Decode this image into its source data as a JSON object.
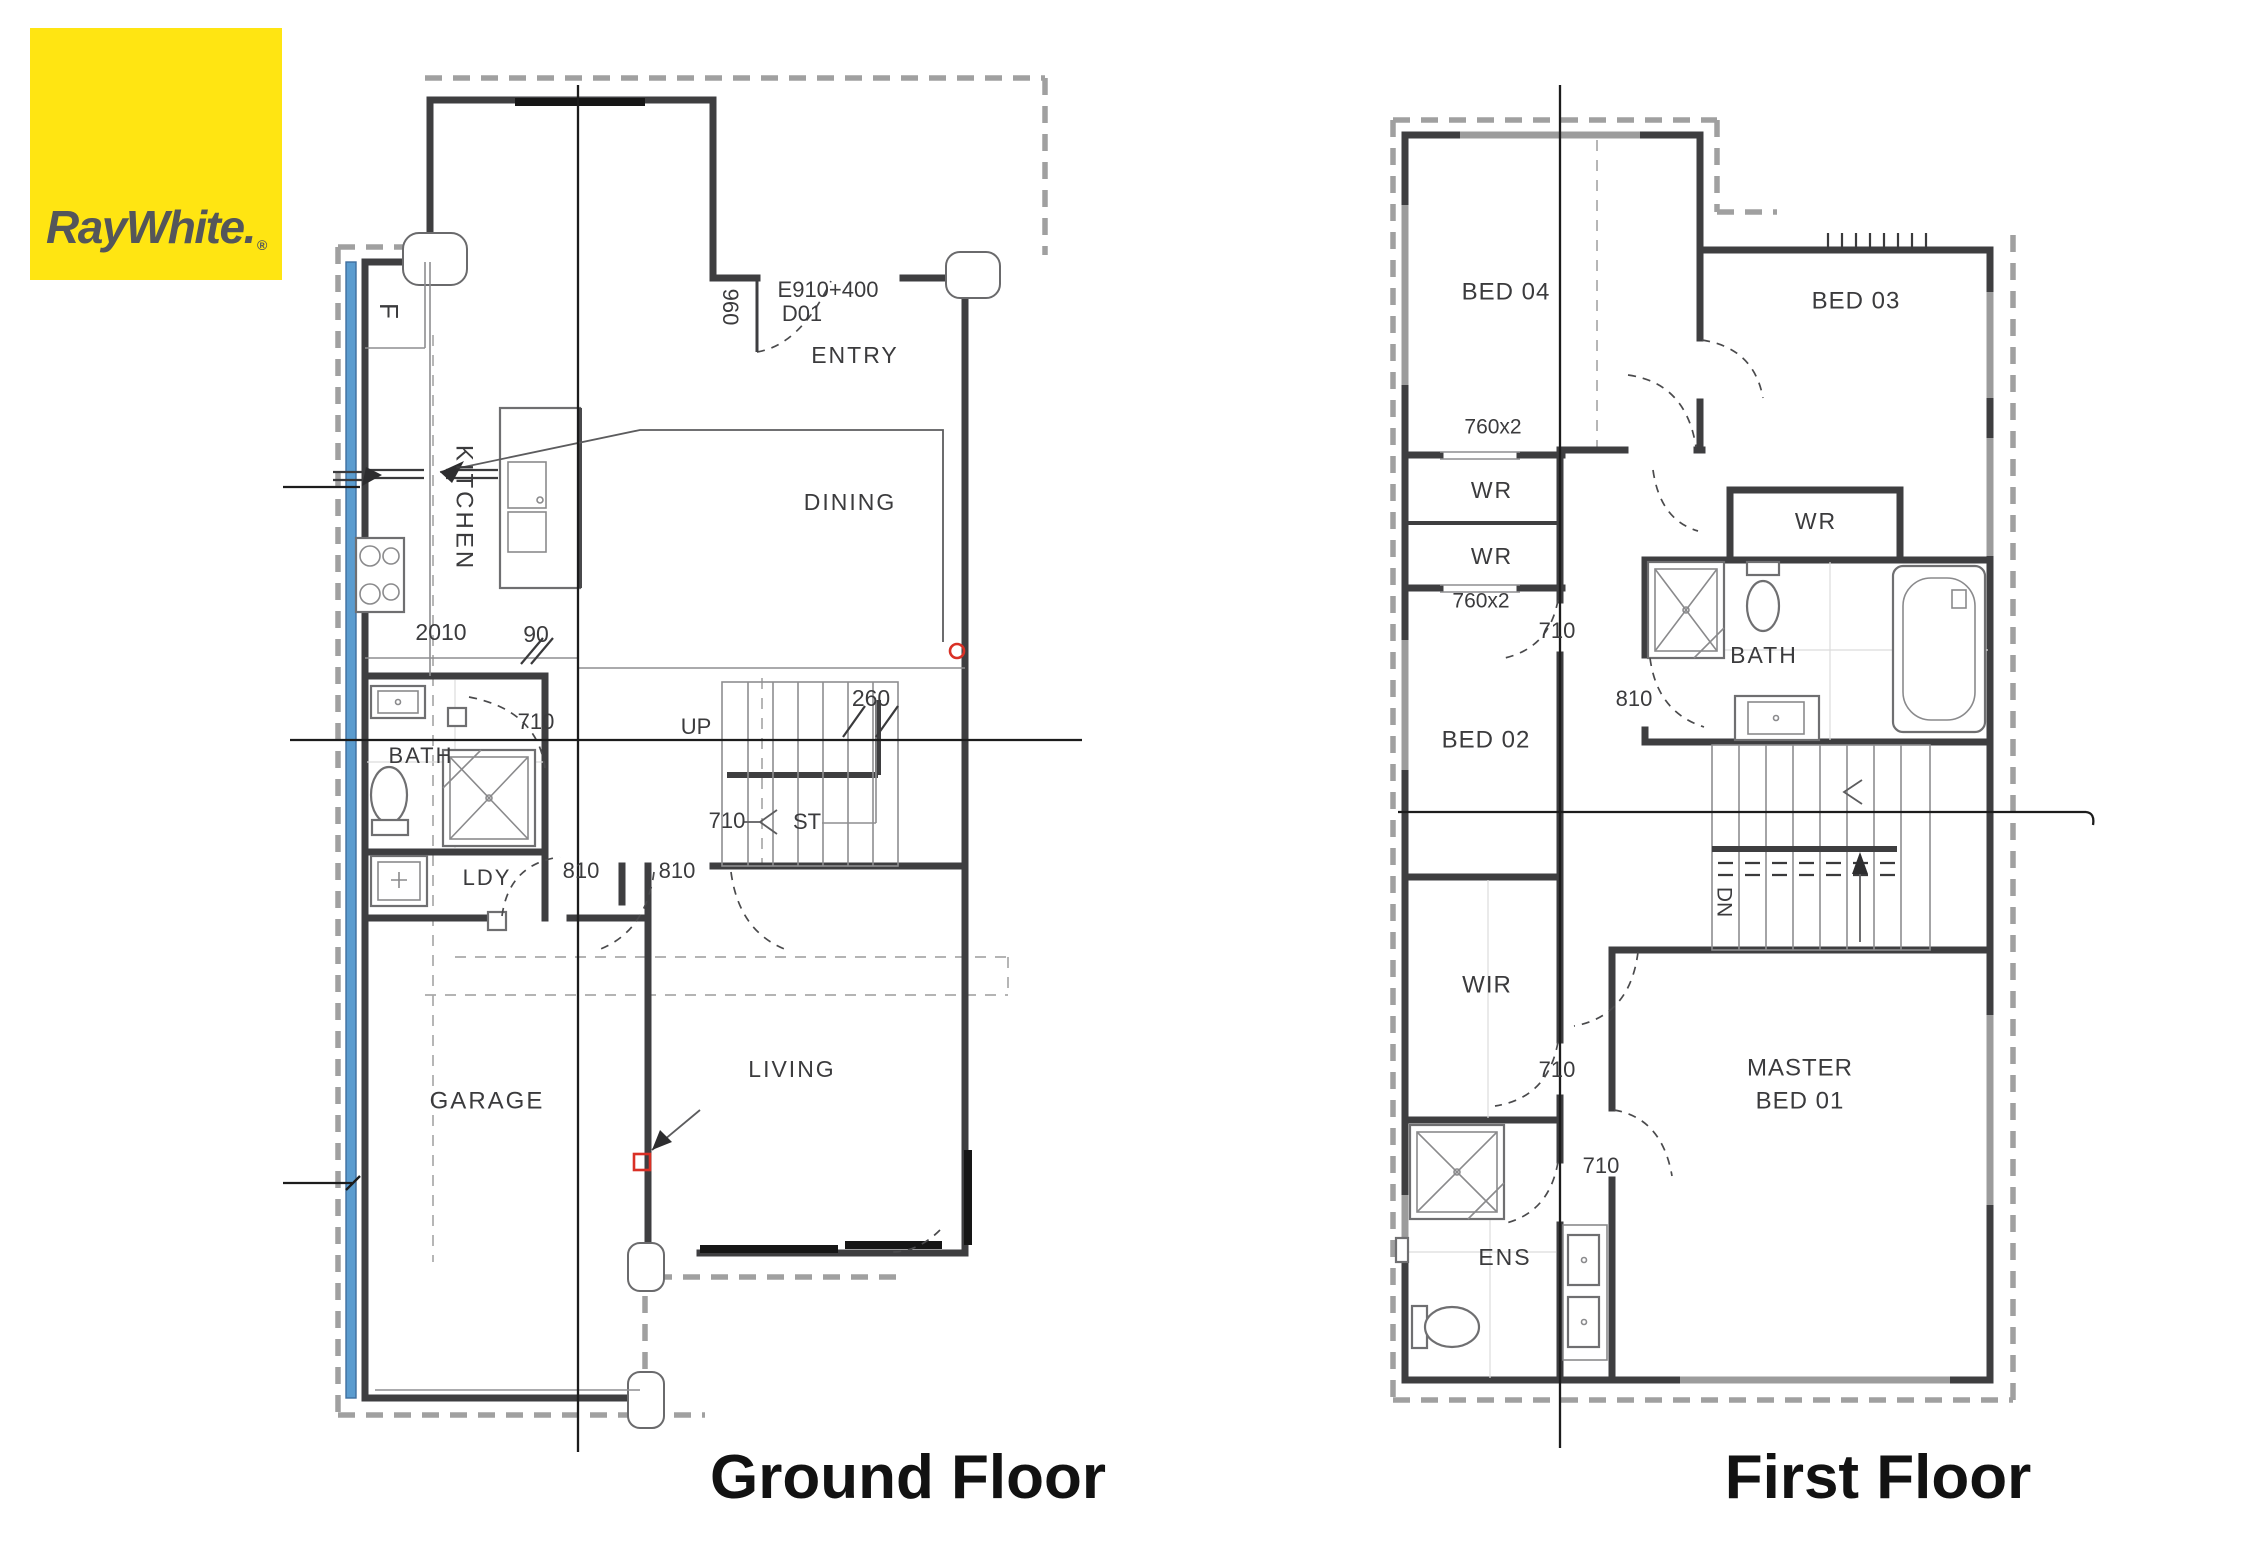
{
  "logo": {
    "brand": "RayWhite.",
    "registered": "®"
  },
  "captions": {
    "ground": "Ground Floor",
    "first": "First Floor"
  },
  "colors": {
    "logo_bg": "#FFE512",
    "logo_fg": "#54565A",
    "wall": "#3E3E40",
    "thin": "#8E8E90",
    "boundary": "#A0A0A0",
    "section": "#1C1C1C",
    "window_blue": "#5B9CCF",
    "marker_red": "#D93025",
    "text": "#3B3B3D",
    "caption": "#121212"
  },
  "ground_floor": {
    "name": "Ground Floor",
    "labels": [
      {
        "id": "fridge",
        "text": "F",
        "x": 387,
        "y": 311,
        "size": 26,
        "rot": 90
      },
      {
        "id": "kitchen",
        "text": "KITCHEN",
        "x": 463,
        "y": 508,
        "size": 24,
        "rot": 90,
        "ls": 3
      },
      {
        "id": "dim-2010",
        "text": "2010",
        "x": 441,
        "y": 634,
        "size": 23
      },
      {
        "id": "dim-90",
        "text": "90",
        "x": 536,
        "y": 636,
        "size": 23
      },
      {
        "id": "dim-710-bath",
        "text": "710",
        "x": 536,
        "y": 723,
        "size": 22
      },
      {
        "id": "room-bath",
        "text": "BATH",
        "x": 421,
        "y": 757,
        "size": 22,
        "ls": 2
      },
      {
        "id": "room-ldy",
        "text": "LDY",
        "x": 487,
        "y": 879,
        "size": 22,
        "ls": 2
      },
      {
        "id": "dim-810-a",
        "text": "810",
        "x": 581,
        "y": 872,
        "size": 22
      },
      {
        "id": "dim-810-b",
        "text": "810",
        "x": 677,
        "y": 872,
        "size": 22
      },
      {
        "id": "dim-960",
        "text": "960",
        "x": 729,
        "y": 307,
        "size": 22,
        "rot": 90
      },
      {
        "id": "entry-code",
        "text": "E910+400",
        "x": 828,
        "y": 291,
        "size": 22
      },
      {
        "id": "entry-door",
        "text": "D01",
        "x": 802,
        "y": 315,
        "size": 22
      },
      {
        "id": "room-entry",
        "text": "ENTRY",
        "x": 855,
        "y": 357,
        "size": 23,
        "ls": 2
      },
      {
        "id": "room-dining",
        "text": "DINING",
        "x": 850,
        "y": 504,
        "size": 23,
        "ls": 2
      },
      {
        "id": "stairs-up",
        "text": "UP",
        "x": 696,
        "y": 728,
        "size": 22
      },
      {
        "id": "dim-260",
        "text": "260",
        "x": 871,
        "y": 700,
        "size": 23
      },
      {
        "id": "dim-710-st",
        "text": "710",
        "x": 727,
        "y": 822,
        "size": 22
      },
      {
        "id": "stairs-st",
        "text": "ST",
        "x": 807,
        "y": 823,
        "size": 22
      },
      {
        "id": "room-garage",
        "text": "GARAGE",
        "x": 487,
        "y": 1102,
        "size": 24,
        "ls": 2
      },
      {
        "id": "room-living",
        "text": "LIVING",
        "x": 792,
        "y": 1071,
        "size": 23,
        "ls": 2
      }
    ]
  },
  "first_floor": {
    "name": "First Floor",
    "labels": [
      {
        "id": "room-bed04",
        "text": "BED 04",
        "x": 1506,
        "y": 293,
        "size": 24,
        "ls": 1
      },
      {
        "id": "room-bed03",
        "text": "BED 03",
        "x": 1856,
        "y": 302,
        "size": 24,
        "ls": 1
      },
      {
        "id": "dim-760x2-a",
        "text": "760x2",
        "x": 1493,
        "y": 428,
        "size": 21
      },
      {
        "id": "room-wr1",
        "text": "WR",
        "x": 1492,
        "y": 492,
        "size": 23,
        "ls": 2
      },
      {
        "id": "room-wr2",
        "text": "WR",
        "x": 1492,
        "y": 558,
        "size": 23,
        "ls": 2
      },
      {
        "id": "dim-760x2-b",
        "text": "760x2",
        "x": 1481,
        "y": 602,
        "size": 21
      },
      {
        "id": "room-wr3",
        "text": "WR",
        "x": 1816,
        "y": 523,
        "size": 23,
        "ls": 2
      },
      {
        "id": "dim-710-bed02",
        "text": "710",
        "x": 1557,
        "y": 632,
        "size": 22
      },
      {
        "id": "room-bath",
        "text": "BATH",
        "x": 1764,
        "y": 657,
        "size": 23,
        "ls": 2
      },
      {
        "id": "dim-810",
        "text": "810",
        "x": 1634,
        "y": 700,
        "size": 22
      },
      {
        "id": "room-bed02",
        "text": "BED 02",
        "x": 1486,
        "y": 741,
        "size": 24,
        "ls": 1
      },
      {
        "id": "stairs-dn",
        "text": "DN",
        "x": 1723,
        "y": 902,
        "size": 21,
        "rot": 90
      },
      {
        "id": "room-wir",
        "text": "WIR",
        "x": 1487,
        "y": 986,
        "size": 24,
        "ls": 1
      },
      {
        "id": "dim-710-wir",
        "text": "710",
        "x": 1557,
        "y": 1071,
        "size": 22
      },
      {
        "id": "room-master-1",
        "text": "MASTER",
        "x": 1800,
        "y": 1069,
        "size": 24,
        "ls": 1
      },
      {
        "id": "room-master-2",
        "text": "BED 01",
        "x": 1800,
        "y": 1102,
        "size": 24,
        "ls": 1
      },
      {
        "id": "dim-710-ens",
        "text": "710",
        "x": 1601,
        "y": 1167,
        "size": 22
      },
      {
        "id": "room-ens",
        "text": "ENS",
        "x": 1505,
        "y": 1259,
        "size": 23,
        "ls": 2
      }
    ]
  }
}
